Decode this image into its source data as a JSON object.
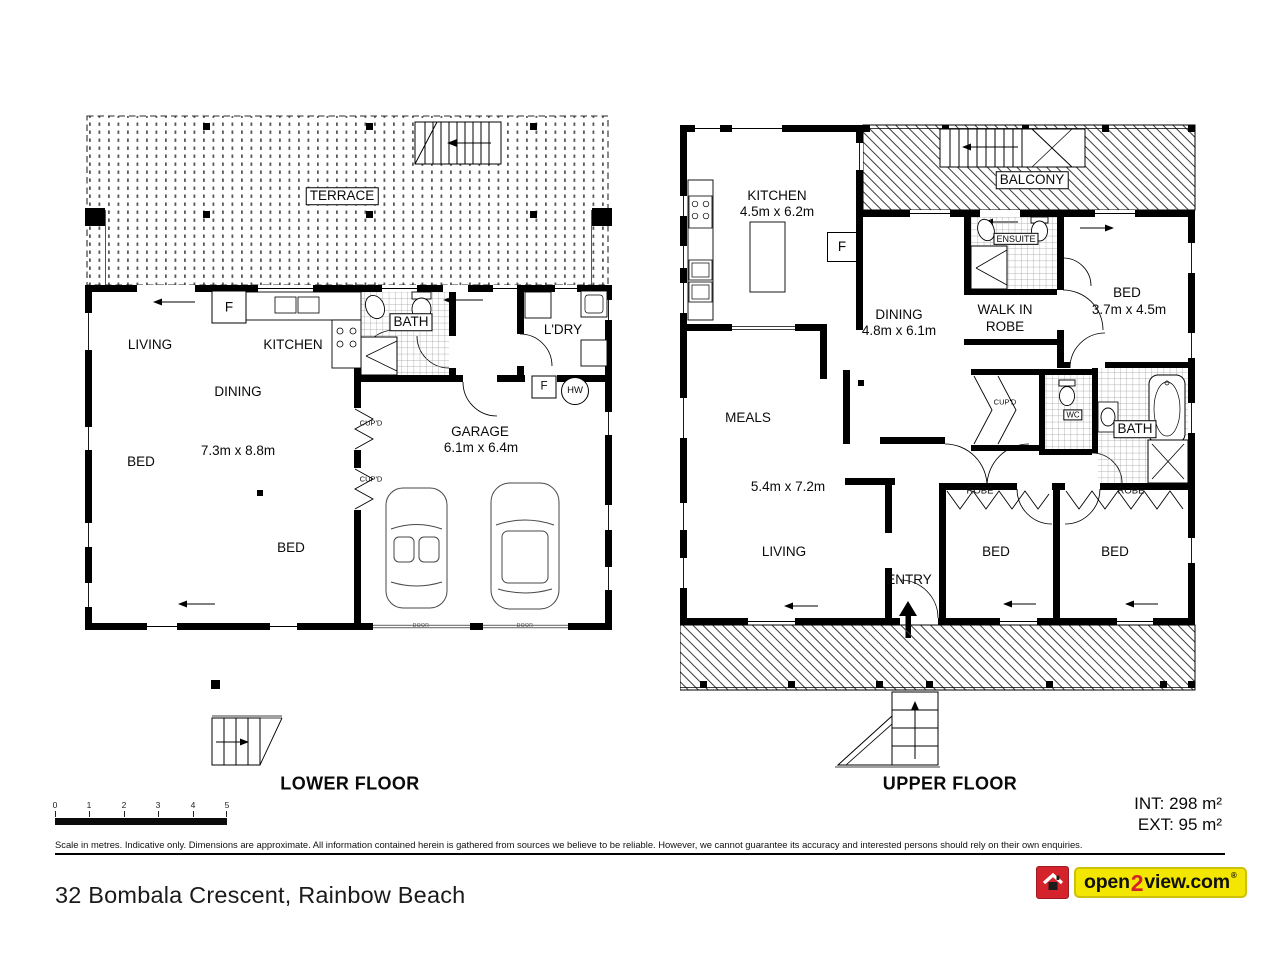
{
  "colors": {
    "logo_red": "#d4232a",
    "logo_yellow": "#f3e600",
    "ink": "#000000"
  },
  "lower": {
    "title": "LOWER FLOOR",
    "terrace": "TERRACE",
    "living": "LIVING",
    "kitchen": "KITCHEN",
    "dining": "DINING",
    "main_dims": "7.3m x 8.8m",
    "bed_left": "BED",
    "bed_mid": "BED",
    "bath": "BATH",
    "laundry": "L'DRY",
    "garage": "GARAGE",
    "garage_dims": "6.1m x 6.4m",
    "fridge": "F",
    "laundry_fridge": "F",
    "hot_water": "HW",
    "cupboard_1": "CUP'D",
    "cupboard_2": "CUP'D",
    "door_1": "DOOR",
    "door_2": "DOOR"
  },
  "upper": {
    "title": "UPPER FLOOR",
    "balcony": "BALCONY",
    "kitchen": "KITCHEN",
    "kitchen_dims": "4.5m x 6.2m",
    "fridge": "F",
    "dining": "DINING",
    "dining_dims": "4.8m x 6.1m",
    "ensuite": "ENSUITE",
    "walk_in_robe_line1": "WALK IN",
    "walk_in_robe_line2": "ROBE",
    "bed_master": "BED",
    "bed_master_dims": "3.7m x 4.5m",
    "meals": "MEALS",
    "living": "LIVING",
    "living_dims": "5.4m x 7.2m",
    "entry": "ENTRY",
    "cupboard": "CUP'D",
    "wc": "WC",
    "bath": "BATH",
    "bed_mid": "BED",
    "bed_right": "BED",
    "robe_mid": "ROBE",
    "robe_right": "ROBE"
  },
  "scale": {
    "ticks": [
      "0",
      "1",
      "2",
      "3",
      "4",
      "5"
    ]
  },
  "footer": {
    "disclaimer": "Scale in metres. Indicative only. Dimensions are approximate. All information contained herein is gathered from sources we believe to be reliable. However, we cannot guarantee its accuracy and interested persons should rely on their own enquiries.",
    "area_int": "INT: 298 m²",
    "area_ext": "EXT: 95 m²",
    "address": "32 Bombala Crescent, Rainbow Beach",
    "logo_open": "open",
    "logo_two": "2",
    "logo_view": "view.com",
    "logo_reg": "®"
  }
}
